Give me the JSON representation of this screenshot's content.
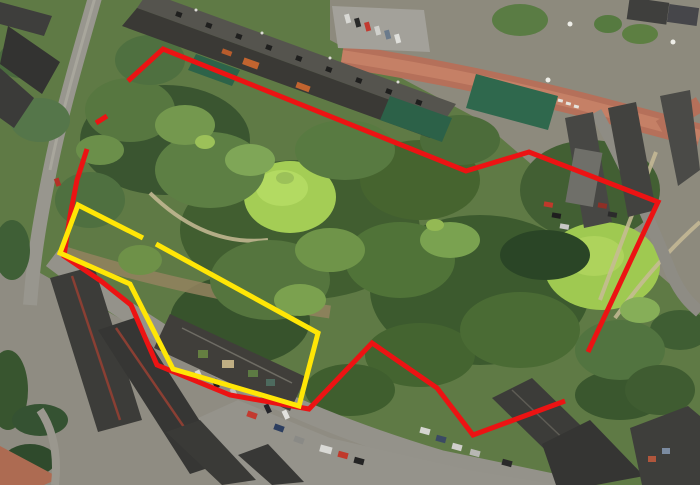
{
  "map": {
    "view": "aerial-satellite-imagery",
    "width_px": 700,
    "height_px": 485,
    "visible_text": ""
  },
  "overlays": {
    "outlines": [
      {
        "id": "red-boundary",
        "color": "#ec1313",
        "stroke_width": 5,
        "segments": [
          [
            [
              128,
              81
            ],
            [
              163,
              49
            ],
            [
              466,
              171
            ],
            [
              529,
              152
            ],
            [
              658,
              202
            ],
            [
              588,
              352
            ]
          ],
          [
            [
              107,
              116
            ],
            [
              96,
              123
            ]
          ],
          [
            [
              87,
              149
            ],
            [
              77,
              180
            ],
            [
              70,
              216
            ],
            [
              64,
              256
            ],
            [
              101,
              281
            ],
            [
              131,
              305
            ],
            [
              157,
              365
            ],
            [
              230,
              395
            ],
            [
              309,
              409
            ],
            [
              372,
              343
            ],
            [
              437,
              388
            ],
            [
              473,
              435
            ],
            [
              565,
              401
            ]
          ]
        ]
      },
      {
        "id": "yellow-boundary",
        "color": "#ffe606",
        "stroke_width": 5,
        "segments": [
          [
            [
              156,
              244
            ],
            [
              318,
              333
            ],
            [
              299,
              406
            ],
            [
              173,
              369
            ],
            [
              130,
              284
            ],
            [
              60,
              253
            ],
            [
              78,
              205
            ],
            [
              143,
              238
            ]
          ]
        ]
      }
    ]
  }
}
